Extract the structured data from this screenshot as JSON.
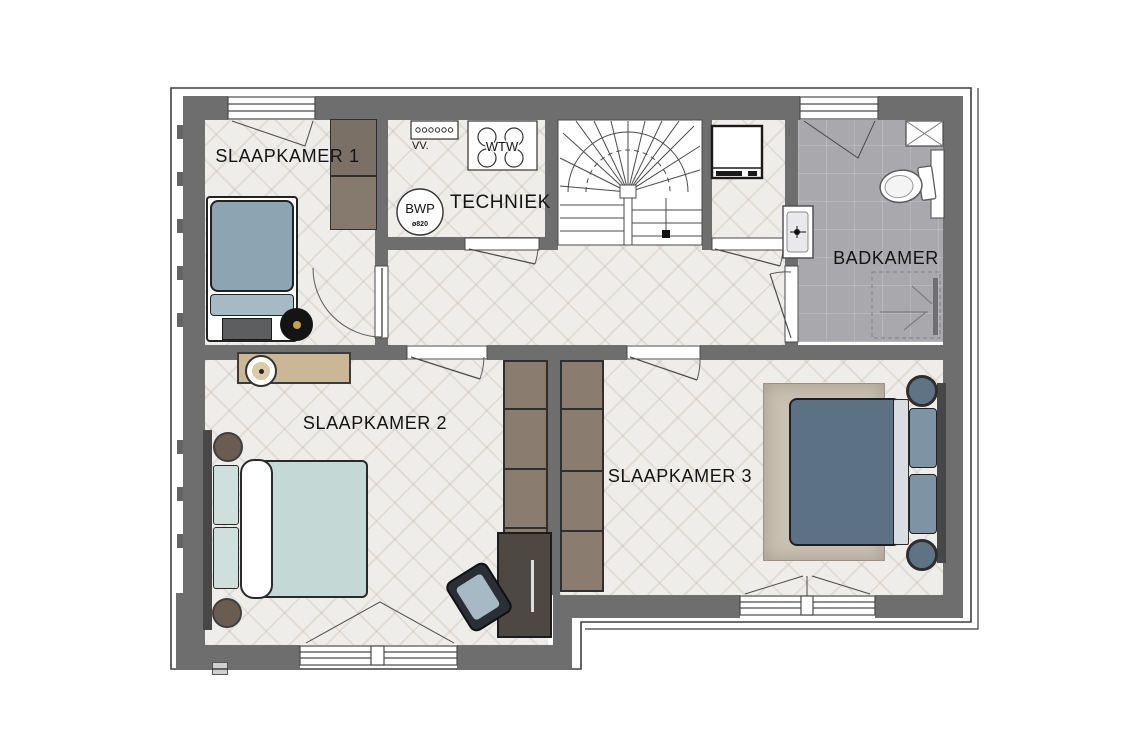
{
  "plan": {
    "title": "Verdieping plattegrond",
    "rooms": [
      {
        "id": "slaapkamer1",
        "label": "SLAAPKAMER 1"
      },
      {
        "id": "techniek",
        "label": "TECHNIEK"
      },
      {
        "id": "badkamer",
        "label": "BADKAMER"
      },
      {
        "id": "slaapkamer2",
        "label": "SLAAPKAMER 2"
      },
      {
        "id": "slaapkamer3",
        "label": "SLAAPKAMER 3"
      }
    ],
    "equipment": {
      "vv_label": "VV.",
      "wtw_label": "WTW",
      "bwp_label": "BWP",
      "bwp_diameter": "ø820"
    },
    "colors": {
      "wall": "#6e6e6e",
      "wood_floor": "#efedea",
      "bathroom_tile": "#a9a9ad",
      "bed1_duvet": "#8da4b3",
      "bed2_duvet": "#c4d9d5",
      "bed3_duvet": "#5d7184",
      "cabinet_wood": "#8a7c6f",
      "desk_wood": "#4e4842",
      "rug": "#c9c1b2",
      "sideboard": "#c9b795",
      "line_dark": "#2a2a2a"
    }
  }
}
